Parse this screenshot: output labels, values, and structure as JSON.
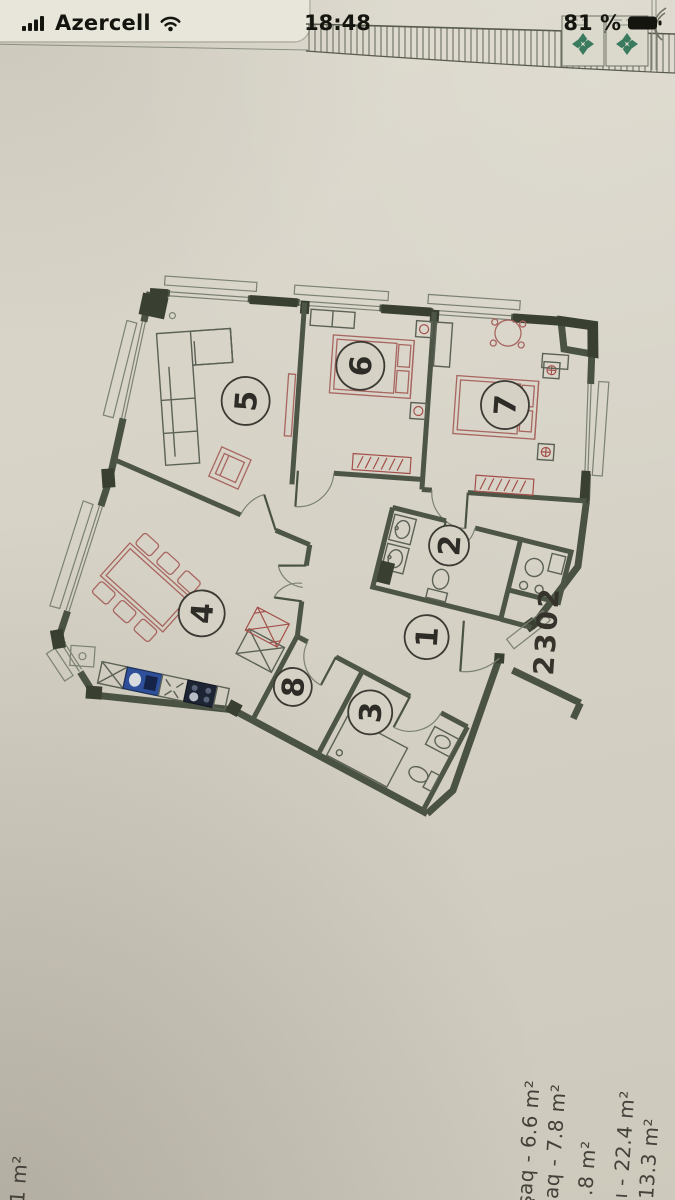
{
  "status_bar": {
    "carrier": "Azercell",
    "time": "18:48",
    "battery": "81 %"
  },
  "plan": {
    "apartment_number": "2302",
    "rooms": [
      {
        "number": "1"
      },
      {
        "number": "2"
      },
      {
        "number": "3"
      },
      {
        "number": "4"
      },
      {
        "number": "5"
      },
      {
        "number": "6"
      },
      {
        "number": "7"
      },
      {
        "number": "8"
      }
    ],
    "area_labels": [
      {
        "text": "şaq - 6.6 m²"
      },
      {
        "text": "şaq - 7.8 m²"
      },
      {
        "text": ".8 m²"
      },
      {
        "text": "ğı - 22.4 m²"
      },
      {
        "text": "- 13.3 m²"
      }
    ],
    "corner_label": "1 m²"
  }
}
